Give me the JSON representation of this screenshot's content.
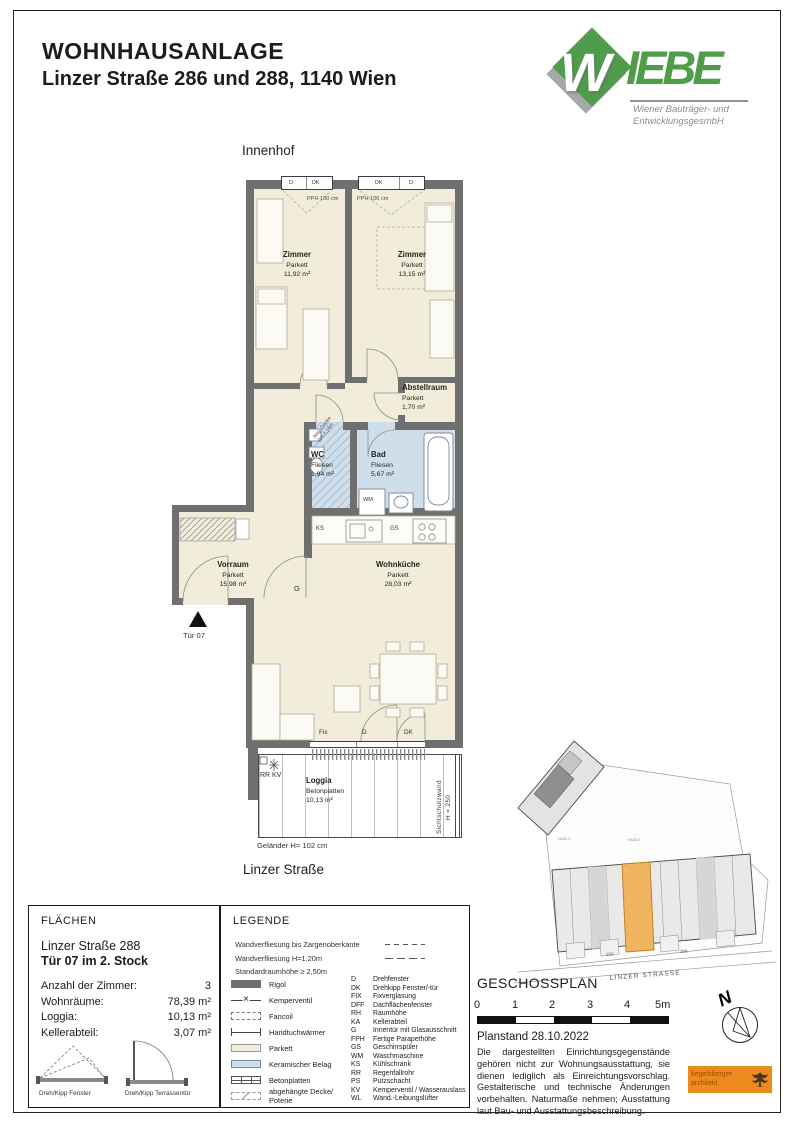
{
  "colors": {
    "wall": "#6f6f6f",
    "parkett": "#f2ecda",
    "tile": "#cfdeeb",
    "green": "#4f9d4b",
    "orange": "#f0b45e",
    "stamp": "#ec8a1e"
  },
  "header": {
    "title": "WOHNHAUSANLAGE",
    "subtitle": "Linzer Straße 286 und 288, 1140 Wien"
  },
  "logo": {
    "w": "W",
    "iebe": "IEBE",
    "tagline1": "Wiener Bauträger- und",
    "tagline2": "EntwicklungsgesmbH"
  },
  "plan": {
    "innenhof": "Innenhof",
    "strasse": "Linzer Straße",
    "windows": {
      "left": [
        "D",
        "DK"
      ],
      "right": [
        "DK",
        "D"
      ],
      "pph_left": "PPH 100 cm",
      "pph_right": "PPH 106 cm"
    },
    "rooms": {
      "zimmer1": {
        "name": "Zimmer",
        "floor": "Parkett",
        "area": "11,92 m²"
      },
      "zimmer2": {
        "name": "Zimmer",
        "floor": "Parkett",
        "area": "13,15 m²"
      },
      "abstellraum": {
        "name": "Abstellraum",
        "floor": "Parkett",
        "area": "1,70 m²"
      },
      "wc": {
        "name": "WC",
        "floor": "Fliesen",
        "area": "1,94 m²",
        "note1": "Abg. Decke",
        "note2": "RH 2,16m"
      },
      "bad": {
        "name": "Bad",
        "floor": "Fliesen",
        "area": "5,67 m²"
      },
      "vorraum": {
        "name": "Vorraum",
        "floor": "Parkett",
        "area": "15,98 m²"
      },
      "wohnkueche": {
        "name": "Wohnküche",
        "floor": "Parkett",
        "area": "28,03 m²"
      },
      "loggia": {
        "name": "Loggia",
        "floor": "Betonplatten",
        "area": "10,13 m²"
      }
    },
    "labels": {
      "tuer": "Tür 07",
      "g": "G",
      "wm": "WM",
      "ks": "KS",
      "gs": "GS",
      "rrkv": "RR KV",
      "fix": "Fix",
      "d": "D",
      "dk": "DK",
      "sichtschutz": "Sichtschutzwand",
      "h250": "H = 250",
      "gelaender": "Geländer H= 102 cm"
    }
  },
  "flaechen": {
    "title": "FLÄCHEN",
    "address": "Linzer Straße 288",
    "unit": "Tür 07 im 2. Stock",
    "rows": [
      {
        "label": "Anzahl der Zimmer:",
        "value": "3"
      },
      {
        "label": "Wohnräume:",
        "value": "78,39 m²"
      },
      {
        "label": "Loggia:",
        "value": "10,13 m²"
      },
      {
        "label": "Kellerabteil:",
        "value": "3,07 m²"
      }
    ],
    "sym_window": "Dreh/Kipp Fenster",
    "sym_door": "Dreh/Kipp Terrassentür"
  },
  "legende": {
    "title": "LEGENDE",
    "notes": [
      {
        "text": "Wandverfliesung bis Zargenoberkante",
        "dash": "a"
      },
      {
        "text": "Wandverfliesung H=1,20m",
        "dash": "b"
      },
      {
        "text": "Standardraumhöhe ≥ 2,50m",
        "dash": ""
      }
    ],
    "items": [
      {
        "sym": "rigol",
        "label": "Rigol"
      },
      {
        "sym": "valve",
        "label": "Kemperventil"
      },
      {
        "sym": "fancoil",
        "label": "Fancoil"
      },
      {
        "sym": "towel",
        "label": "Handtuchwärmer"
      },
      {
        "sym": "parkett",
        "label": "Parkett"
      },
      {
        "sym": "ceramic",
        "label": "Keramischer Belag"
      },
      {
        "sym": "beton",
        "label": "Betonplatten"
      },
      {
        "sym": "ceiling",
        "label": "abgehängte Decke/ Poterie"
      }
    ],
    "abbrs": [
      {
        "k": "D",
        "v": "Drehfenster"
      },
      {
        "k": "DK",
        "v": "Drehkipp Fenster/-tür"
      },
      {
        "k": "FIX",
        "v": "Fixverglasung"
      },
      {
        "k": "DFF",
        "v": "Dachflächenfenster"
      },
      {
        "k": "RH",
        "v": "Raumhöhe"
      },
      {
        "k": "KA",
        "v": "Kellerabteil"
      },
      {
        "k": "G",
        "v": "Innentür mit Glasausschnitt"
      },
      {
        "k": "FPH",
        "v": "Fertige Parapethöhe"
      },
      {
        "k": "GS",
        "v": "Geschirrspüler"
      },
      {
        "k": "WM",
        "v": "Waschmaschine"
      },
      {
        "k": "KS",
        "v": "Kühlschrank"
      },
      {
        "k": "RR",
        "v": "Regenfallrohr"
      },
      {
        "k": "PS",
        "v": "Putzschacht"
      },
      {
        "k": "KV",
        "v": "Kemperventil / Wasserauslass"
      },
      {
        "k": "WL",
        "v": "Wand.-Leibungslüfter"
      }
    ]
  },
  "siteplan": {
    "street": "LINZER STRASSE",
    "haus1": "HAUS 1",
    "haus2": "HAUS 2",
    "nr288": "288",
    "nr286": "286"
  },
  "geschossplan": {
    "title": "GESCHOSSPLAN",
    "ticks": [
      "0",
      "1",
      "2",
      "3",
      "4",
      "5m"
    ],
    "planstand": "Planstand 28.10.2022",
    "disclaimer": "Die dargestellten Einrichtungsgegenstände gehören nicht zur Wohnungsausstattung, sie dienen lediglich als Einreichtungsvorschlag. Gestalterische und technische Änderungen vorbehalten. Naturmaße nehmen; Ausstattung laut Bau- und Ausstattungsbeschreibung."
  },
  "compass": {
    "n": "N"
  },
  "stamp": {
    "line1": "hegelsberger",
    "line2": "architekt"
  }
}
